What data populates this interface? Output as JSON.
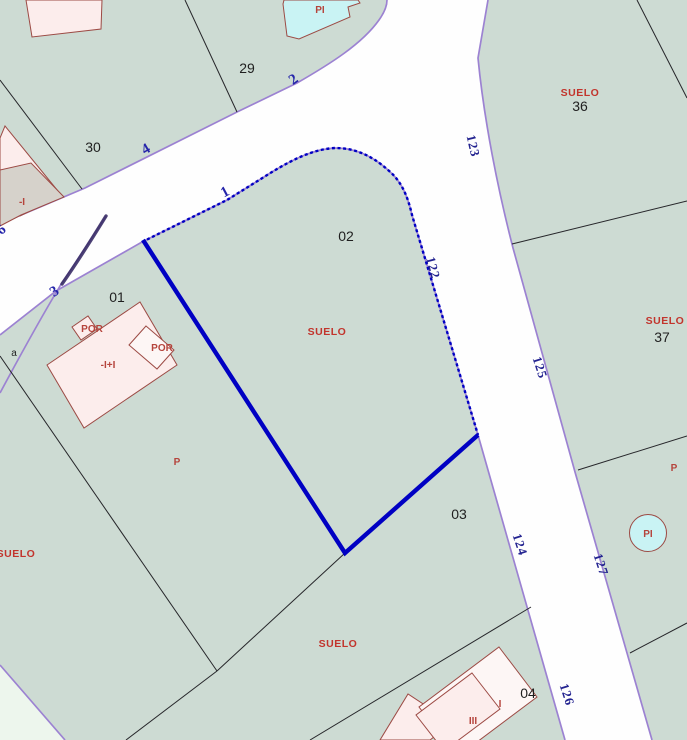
{
  "map": {
    "type": "cadastral-parcel-map",
    "selected_parcel": "02",
    "colors": {
      "bg": "#cddbd3",
      "road": "#fefefe",
      "road-edge": "#9c82d2",
      "selection": "#0000c3",
      "curve-dark": "#3a2d66",
      "black-line": "#26262a",
      "parcel-text": "#1f1f1f",
      "red-text": "#c2342c",
      "building-red-text": "#b5443c",
      "blue-text": "#2525aa",
      "roadnum-text": "#232390",
      "building-fill": "#fcedec",
      "building-stroke": "#9c4a44",
      "gray-fill": "#d6d2cb",
      "cyan-fill": "#c9f3f4",
      "annex-fill": "#fdf6f5",
      "pale-corner": "#edf6ed"
    },
    "parcel_labels": [
      {
        "text": "29",
        "x": 247,
        "y": 73
      },
      {
        "text": "30",
        "x": 93,
        "y": 152
      },
      {
        "text": "01",
        "x": 117,
        "y": 302
      },
      {
        "text": "02",
        "x": 346,
        "y": 241
      },
      {
        "text": "03",
        "x": 459,
        "y": 519
      },
      {
        "text": "04",
        "x": 528,
        "y": 698
      },
      {
        "text": "36",
        "x": 580,
        "y": 111
      },
      {
        "text": "37",
        "x": 662,
        "y": 342
      }
    ],
    "annotation_labels": [
      {
        "text": "a",
        "x": 14,
        "y": 356
      }
    ],
    "landuse_labels": [
      {
        "text": "SUELO",
        "x": 327,
        "y": 335
      },
      {
        "text": "SUELO",
        "x": 580,
        "y": 96
      },
      {
        "text": "SUELO",
        "x": 665,
        "y": 324
      },
      {
        "text": "SUELO",
        "x": 16,
        "y": 557
      },
      {
        "text": "SUELO",
        "x": 338,
        "y": 647
      }
    ],
    "building_labels": [
      {
        "text": "POR",
        "x": 92,
        "y": 332
      },
      {
        "text": "POR",
        "x": 162,
        "y": 351
      },
      {
        "text": "-I+I",
        "x": 108,
        "y": 368
      },
      {
        "text": "P",
        "x": 177,
        "y": 465
      },
      {
        "text": "P",
        "x": 674,
        "y": 471
      },
      {
        "text": "PI",
        "x": 320,
        "y": 13
      },
      {
        "text": "PI",
        "x": 648,
        "y": 537
      },
      {
        "text": "III",
        "x": 473,
        "y": 724
      },
      {
        "text": "I",
        "x": 500,
        "y": 707
      },
      {
        "text": "-I",
        "x": 22,
        "y": 205
      }
    ],
    "street_numbers": [
      {
        "text": "6",
        "x": 4,
        "y": 233,
        "rot": -42
      },
      {
        "text": "4",
        "x": 148,
        "y": 153,
        "rot": -30
      },
      {
        "text": "2",
        "x": 296,
        "y": 83,
        "rot": -36
      },
      {
        "text": "3",
        "x": 57,
        "y": 295,
        "rot": -36
      },
      {
        "text": "1",
        "x": 227,
        "y": 196,
        "rot": -28
      }
    ],
    "road_numbers": [
      {
        "text": "123",
        "x": 469,
        "y": 147,
        "rot": 77
      },
      {
        "text": "122",
        "x": 429,
        "y": 269,
        "rot": 75
      },
      {
        "text": "125",
        "x": 536,
        "y": 369,
        "rot": 72
      },
      {
        "text": "124",
        "x": 516,
        "y": 546,
        "rot": 72
      },
      {
        "text": "127",
        "x": 597,
        "y": 566,
        "rot": 72
      },
      {
        "text": "126",
        "x": 563,
        "y": 696,
        "rot": 72
      }
    ]
  }
}
